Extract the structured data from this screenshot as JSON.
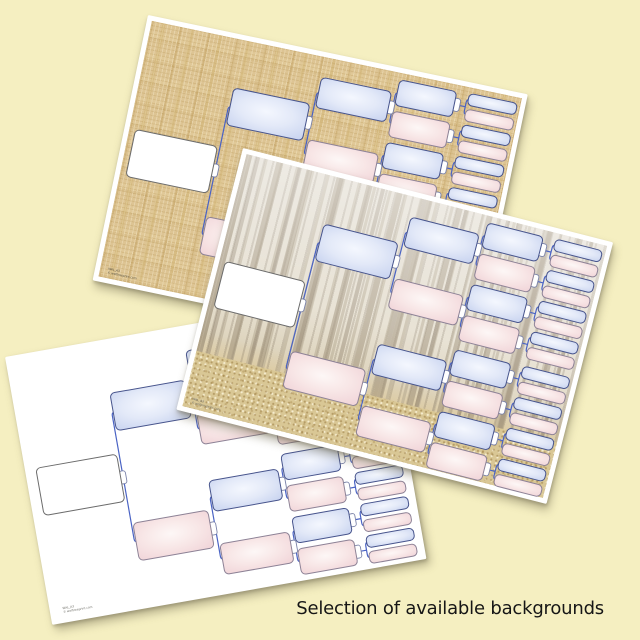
{
  "caption": "Selection of available backgrounds",
  "background_color": "#f5efc1",
  "cards": [
    {
      "name": "burlap-template",
      "background": "burlap-texture",
      "code": "WAL_A3",
      "copyright": "© welltreeprint.com"
    },
    {
      "name": "white-template",
      "background": "plain-white",
      "code": "WAL_A3",
      "copyright": "© welltreeprint.com"
    },
    {
      "name": "forest-template",
      "background": "winter-forest-photo",
      "code": "WAL_A3",
      "copyright": "© welltreeprint.com"
    }
  ],
  "pedigree": {
    "type": "family-tree-template",
    "generations": 5,
    "card_w": 380,
    "card_h": 272,
    "root_cy": 139,
    "spread": [
      66,
      32,
      16,
      8
    ],
    "columns": [
      {
        "cx": 52,
        "w": 82,
        "h": 48
      },
      {
        "cx": 135,
        "w": 76,
        "h": 38
      },
      {
        "cx": 214,
        "w": 70,
        "h": 31
      },
      {
        "cx": 283,
        "w": 57,
        "h": 26
      },
      {
        "cx": 348,
        "w": 48,
        "h": 12
      }
    ],
    "colors": {
      "male_stops": [
        "#f4f7fe",
        "#e3e9f8",
        "#c9d4f0"
      ],
      "female_stops": [
        "#fdf7f6",
        "#f8e7e7",
        "#f1d5d9"
      ],
      "male_border": "#47548c",
      "female_border": "#8d8296",
      "root_fill": "#ffffff",
      "root_border": "#6b6b6b",
      "connector": "#4a63c4",
      "tab_fill": "#ffffff",
      "tab_border": "#7a82a8"
    }
  }
}
